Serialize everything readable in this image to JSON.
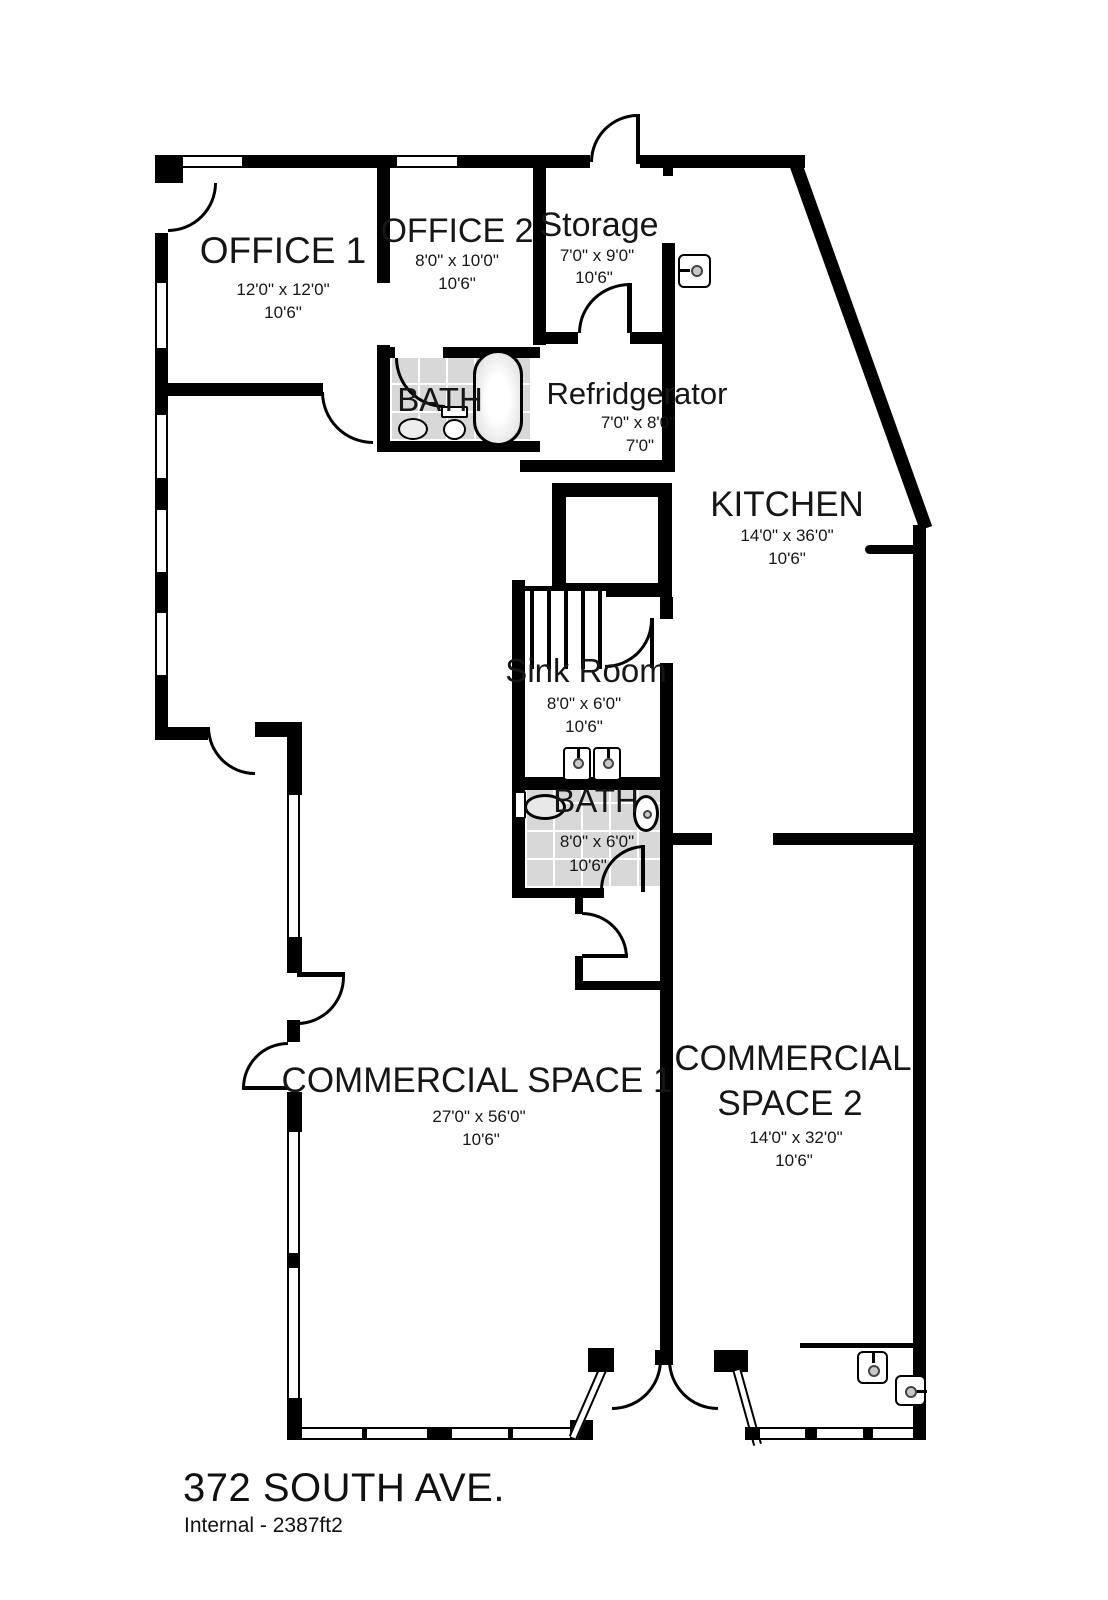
{
  "plan": {
    "title": "372 SOUTH AVE.",
    "subtitle": "Internal - 2387ft2"
  },
  "rooms": {
    "office1": {
      "name": "OFFICE 1",
      "size": "12'0\" x 12'0\"",
      "height": "10'6\""
    },
    "office2": {
      "name": "OFFICE 2",
      "size": "8'0\" x 10'0\"",
      "height": "10'6\""
    },
    "storage": {
      "name": "Storage",
      "size": "7'0\" x 9'0\"",
      "height": "10'6\""
    },
    "bath_upper": {
      "name": "BATH"
    },
    "refridgerator": {
      "name": "Refridgerator",
      "size": "7'0\" x 8'0\"",
      "height": "7'0\""
    },
    "kitchen": {
      "name": "KITCHEN",
      "size": "14'0\" x 36'0\"",
      "height": "10'6\""
    },
    "sink_room": {
      "name": "Sink Room",
      "size": "8'0\" x 6'0\"",
      "height": "10'6\""
    },
    "bath_lower": {
      "name": "BATH",
      "size": "8'0\" x 6'0\"",
      "height": "10'6\""
    },
    "commercial1": {
      "name": "COMMERCIAL SPACE 1",
      "size": "27'0\" x 56'0\"",
      "height": "10'6\""
    },
    "commercial2": {
      "name_line1": "COMMERCIAL",
      "name_line2": "SPACE 2",
      "size": "14'0\" x 32'0\"",
      "height": "10'6\""
    }
  },
  "colors": {
    "wall": "#000000",
    "tile_floor": "#d8d8d8",
    "text": "#161616"
  },
  "fixtures": [
    "bathtub",
    "toilet",
    "wall-sink",
    "double-sink",
    "light-switch",
    "stairs",
    "double-entry-door"
  ]
}
